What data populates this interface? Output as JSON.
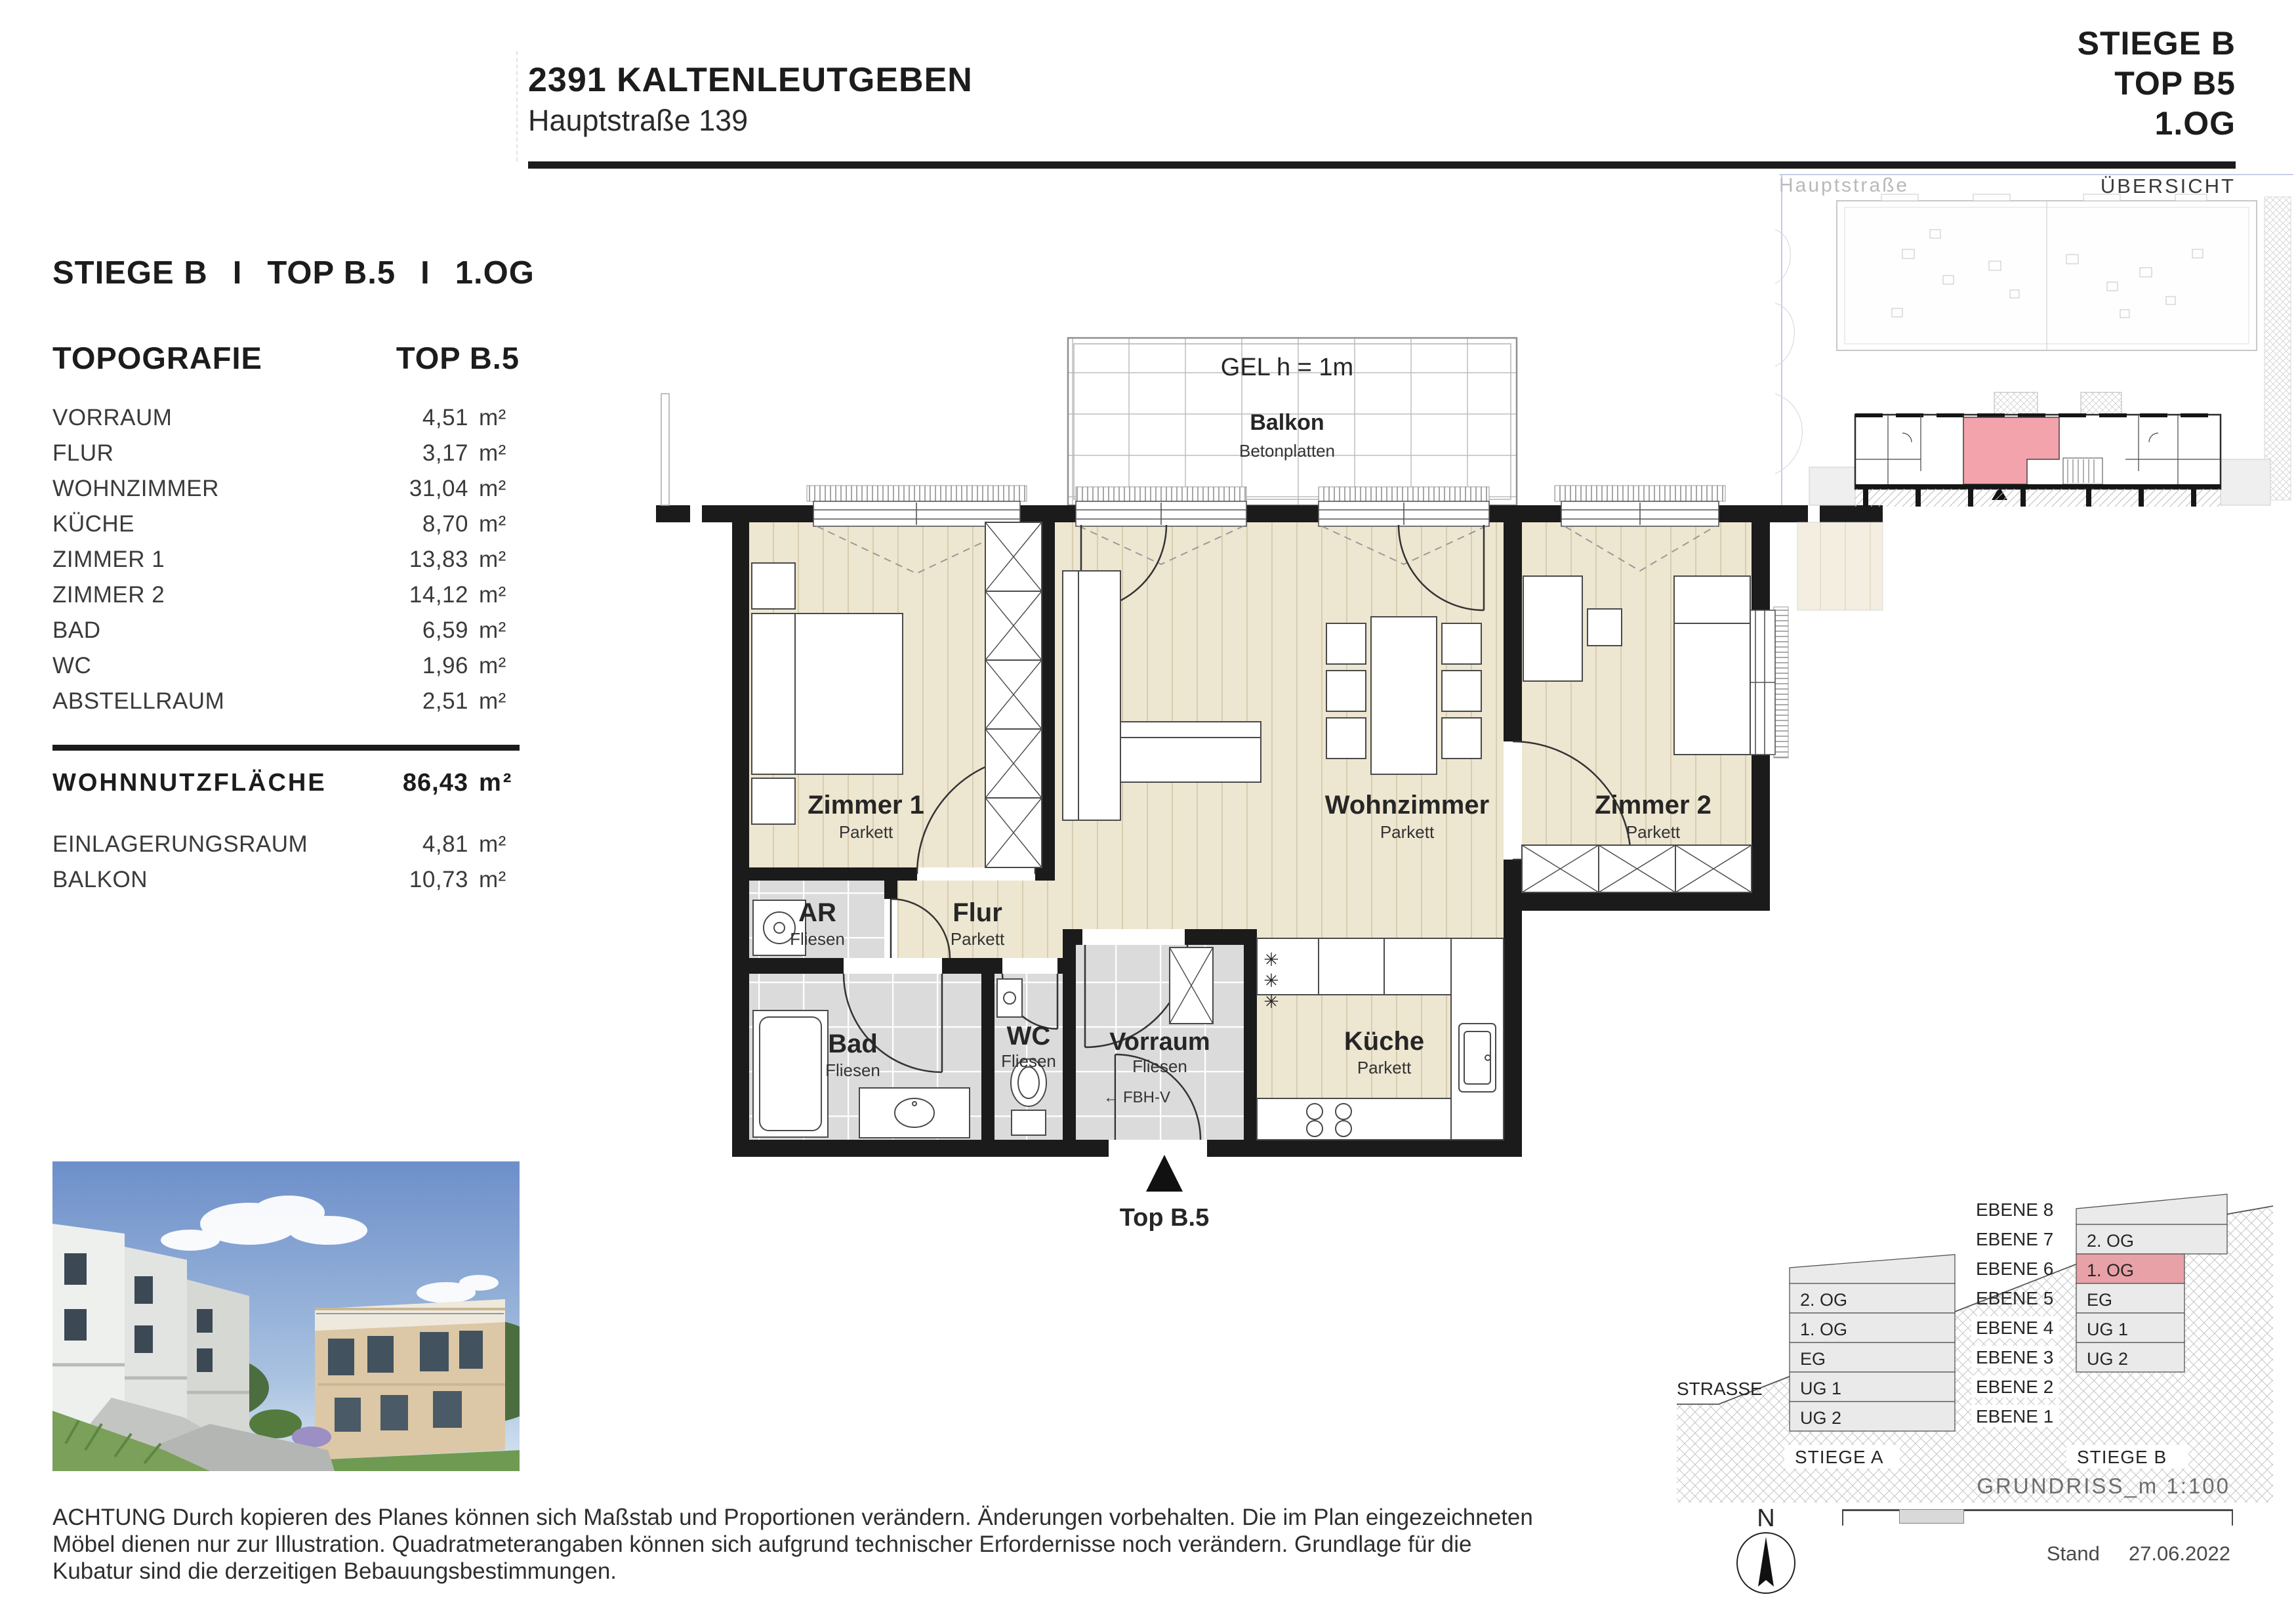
{
  "header": {
    "project_title": "2391 KALTENLEUTGEBEN",
    "address": "Hauptstraße 139",
    "stiege": "STIEGE B",
    "top": "TOP B5",
    "floor": "1.OG",
    "overview_street": "Hauptstraße",
    "overview_title": "ÜBERSICHT"
  },
  "plan_heading": {
    "stiege": "STIEGE B",
    "top": "TOP B.5",
    "floor": "1.OG",
    "separator": "I"
  },
  "topografie": {
    "title": "TOPOGRAFIE",
    "column_title": "TOP B.5",
    "rows": [
      {
        "label": "VORRAUM",
        "value": "4,51",
        "unit": "m²"
      },
      {
        "label": "FLUR",
        "value": "3,17",
        "unit": "m²"
      },
      {
        "label": "WOHNZIMMER",
        "value": "31,04",
        "unit": "m²"
      },
      {
        "label": "KÜCHE",
        "value": "8,70",
        "unit": "m²"
      },
      {
        "label": "ZIMMER 1",
        "value": "13,83",
        "unit": "m²"
      },
      {
        "label": "ZIMMER 2",
        "value": "14,12",
        "unit": "m²"
      },
      {
        "label": "BAD",
        "value": "6,59",
        "unit": "m²"
      },
      {
        "label": "WC",
        "value": "1,96",
        "unit": "m²"
      },
      {
        "label": "ABSTELLRAUM",
        "value": "2,51",
        "unit": "m²"
      }
    ],
    "total": {
      "label": "WOHNNUTZFLÄCHE",
      "value": "86,43",
      "unit": "m²"
    },
    "extras": [
      {
        "label": "EINLAGERUNGSRAUM",
        "value": "4,81",
        "unit": "m²"
      },
      {
        "label": "BALKON",
        "value": "10,73",
        "unit": "m²"
      }
    ]
  },
  "floorplan": {
    "balcony": {
      "gel": "GEL h = 1m",
      "name": "Balkon",
      "floor": "Betonplatten"
    },
    "rooms": {
      "zimmer1": {
        "name": "Zimmer 1",
        "floor": "Parkett"
      },
      "ar": {
        "name": "AR",
        "floor": "Fliesen"
      },
      "flur": {
        "name": "Flur",
        "floor": "Parkett"
      },
      "wohnzimmer": {
        "name": "Wohnzimmer",
        "floor": "Parkett"
      },
      "zimmer2": {
        "name": "Zimmer 2",
        "floor": "Parkett"
      },
      "bad": {
        "name": "Bad",
        "floor": "Fliesen"
      },
      "wc": {
        "name": "WC",
        "floor": "Fliesen"
      },
      "vorraum": {
        "name": "Vorraum",
        "floor": "Fliesen"
      },
      "kueche": {
        "name": "Küche",
        "floor": "Parkett"
      }
    },
    "entrance_label": "Top B.5",
    "fbhv_label": "FBH-V",
    "fbhv_arrow": "←",
    "hook_symbol": "✳"
  },
  "section": {
    "ebenen": [
      "EBENE 8",
      "EBENE 7",
      "EBENE 6",
      "EBENE 5",
      "EBENE 4",
      "EBENE 3",
      "EBENE 2",
      "EBENE 1"
    ],
    "stiege_a_label": "STIEGE A",
    "stiege_b_label": "STIEGE B",
    "stiege_a_floors": [
      "2. OG",
      "1. OG",
      "EG",
      "UG 1",
      "UG 2"
    ],
    "stiege_b_floors": [
      "2. OG",
      "1. OG",
      "EG",
      "UG 1",
      "UG 2"
    ],
    "strasse": "STRASSE"
  },
  "footer": {
    "disclaimer_lines": [
      "ACHTUNG Durch kopieren des Planes können sich Maßstab und Proportionen verändern. Änderungen vorbehalten. Die im Plan eingezeichneten",
      "Möbel dienen nur zur Illustration. Quadratmeterangaben können sich aufgrund technischer Erfordernisse noch verändern. Grundlage für die",
      "Kubatur sind die derzeitigen Bebauungsbestimmungen."
    ],
    "scale_label": "GRUNDRISS_m 1:100",
    "stand_label": "Stand",
    "stand_date": "27.06.2022",
    "north_letter": "N"
  },
  "colors": {
    "accent_red": "#F0A2AA",
    "wall_black": "#1B1B1B",
    "parkett": "#EDE6D1",
    "fliesen": "#DBDBDB"
  }
}
